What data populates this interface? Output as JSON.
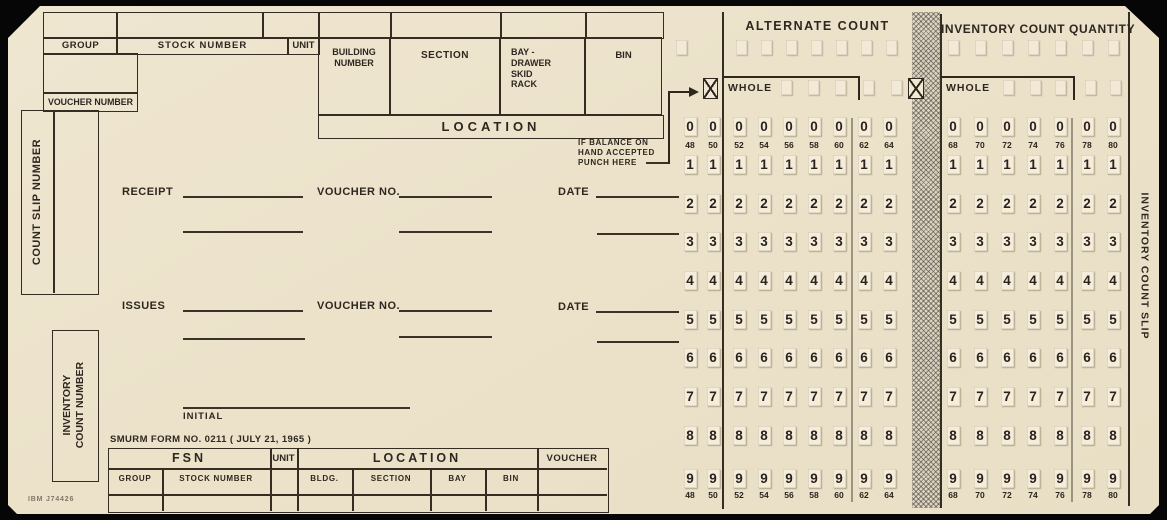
{
  "header": {
    "group": "GROUP",
    "stock_number": "STOCK NUMBER",
    "unit": "UNIT",
    "building_number": "BUILDING NUMBER",
    "section": "SECTION",
    "bay_drawer": "BAY - DRAWER SKID RACK",
    "bin": "BIN",
    "location": "LOCATION",
    "voucher_number": "VOUCHER NUMBER"
  },
  "left": {
    "count_slip_number": "COUNT SLIP NUMBER",
    "inventory_count_number_lines": [
      "INVENTORY",
      "COUNT NUMBER"
    ]
  },
  "middle": {
    "receipt": "RECEIPT",
    "issues": "ISSUES",
    "voucher_no": "VOUCHER NO.",
    "date": "DATE",
    "initial": "INITIAL",
    "form_number": "SMURM FORM NO. 0211 ( JULY 21, 1965 )"
  },
  "balance_note_lines": [
    "IF BALANCE ON",
    "HAND ACCEPTED",
    "PUNCH HERE"
  ],
  "punch": {
    "alternate_title": "ALTERNATE COUNT",
    "inventory_title": "INVENTORY COUNT QUANTITY",
    "whole_label": "WHOLE",
    "digits": [
      "0",
      "1",
      "2",
      "3",
      "4",
      "5",
      "6",
      "7",
      "8",
      "9"
    ],
    "left_columns": [
      "48",
      "50",
      "52",
      "54",
      "56",
      "58",
      "60",
      "62",
      "64"
    ],
    "right_columns": [
      "68",
      "70",
      "72",
      "74",
      "76",
      "78",
      "80"
    ]
  },
  "bottom_table": {
    "fsn": "FSN",
    "unit": "UNIT",
    "location": "LOCATION",
    "voucher": "VOUCHER",
    "group": "GROUP",
    "stock_number": "STOCK NUMBER",
    "bldg": "BLDG.",
    "section": "SECTION",
    "bay": "BAY",
    "bin": "BIN"
  },
  "edge": {
    "inventory_count_slip": "INVENTORY COUNT SLIP",
    "print_code": "IBM J74426"
  },
  "colors": {
    "card_bg": "#ece2cb",
    "ink": "#2e2720",
    "punch_box_bg": "#f5edda",
    "hatch_strip": "#dcd4c2",
    "page_bg": "#060606"
  }
}
